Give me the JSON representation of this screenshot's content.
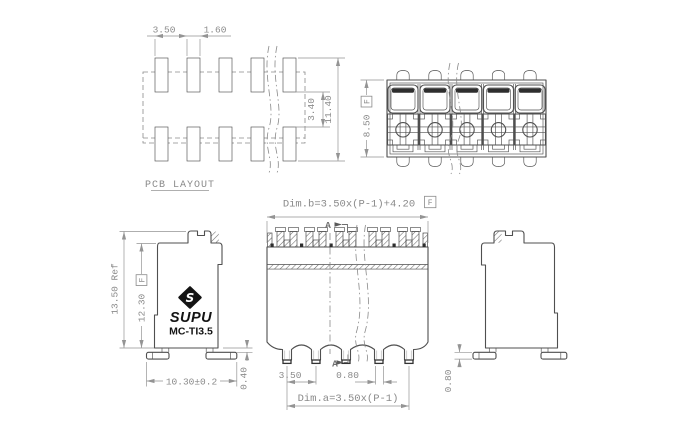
{
  "colors": {
    "line": "#4f4f4f",
    "dark_fill": "#2e2e2e",
    "dimension": "#949494",
    "text_gray": "#8a8a8a",
    "logo_black": "#141414",
    "background": "#ffffff"
  },
  "pcb_layout": {
    "label": "PCB LAYOUT",
    "dim_pitch": "3.50",
    "dim_pad_width": "1.60",
    "dim_row_gap": "3.40",
    "dim_overall_height": "11.40"
  },
  "top_view": {
    "dim_depth": "8.50",
    "datum_flag": "F"
  },
  "front_view": {
    "dim_b_formula": "Dim.b=3.50x(P-1)+4.20",
    "datum_flag": "F",
    "dim_a_formula": "Dim.a=3.50x(P-1)",
    "dim_pin_pitch": "3.50",
    "dim_pin_width": "0.80",
    "section_label": "A"
  },
  "side_left": {
    "dim_height_ref": "13.50 Ref",
    "dim_body_height": "12.30",
    "datum_flag": "F",
    "dim_footprint_width": "10.30±0.2",
    "dim_standoff": "0.40",
    "brand": "SUPU",
    "model": "MC-TI3.5",
    "logo_letter": "S"
  },
  "side_right": {
    "dim_foot_thickness": "0.80"
  }
}
